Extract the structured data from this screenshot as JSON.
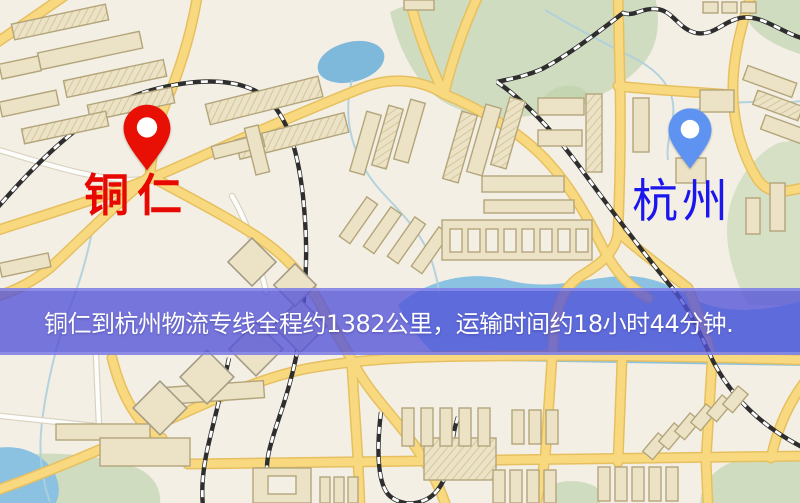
{
  "banner": {
    "text": "铜仁到杭州物流专线全程约1382公里，运输时间约18小时44分钟.",
    "background_color": "#5252d8",
    "text_color": "#ffffff"
  },
  "markers": {
    "origin": {
      "name": "铜仁",
      "pin_color": "#e81005",
      "label_color": "#e60801"
    },
    "destination": {
      "name": "杭州",
      "pin_color": "#5f93f2",
      "label_color": "#1c16ee"
    }
  },
  "route": {
    "origin": "铜仁",
    "destination": "杭州",
    "distance_text": "约1382公里",
    "duration_text": "约18小时44分钟"
  },
  "map_colors": {
    "land": "#f4efe4",
    "park": "#cfdcc0",
    "water": "#8cc2e0",
    "road_major": "#f8d982",
    "road_casing": "#e5c063",
    "building": "#ece2c6",
    "railway": "#2e2e2e"
  }
}
